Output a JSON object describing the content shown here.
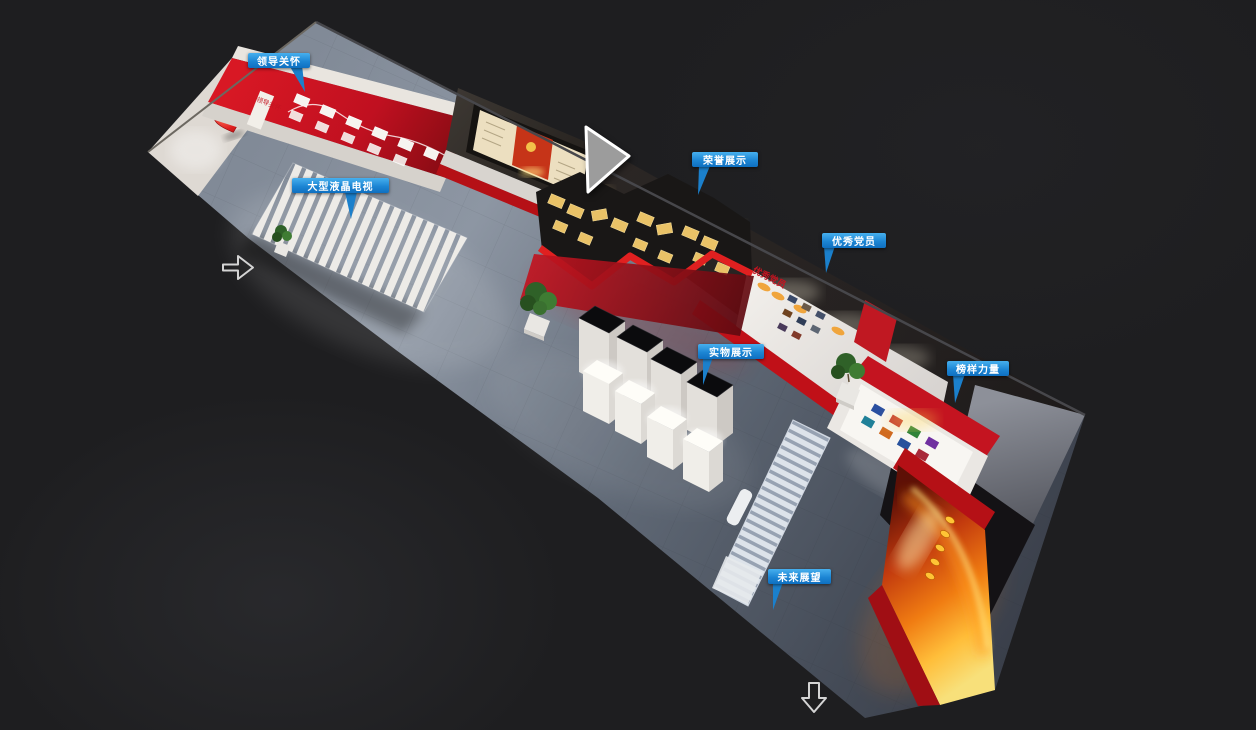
{
  "page": {
    "background": "#1e1e20"
  },
  "hotspots": [
    {
      "name": "leadership-care",
      "label": "领导关怀"
    },
    {
      "name": "large-lcd-tv",
      "label": "大型液晶电视"
    },
    {
      "name": "honor-display",
      "label": "荣誉展示"
    },
    {
      "name": "outstanding-party-members",
      "label": "优秀党员"
    },
    {
      "name": "physical-exhibits",
      "label": "实物展示"
    },
    {
      "name": "role-model-power",
      "label": "榜样力量"
    },
    {
      "name": "future-outlook",
      "label": "未来展望"
    }
  ],
  "wall_texts": {
    "leadership_wall_sign": "领导关怀",
    "party_members_wall_sign": "优秀党员"
  },
  "icons": {
    "nav_left": "arrow-right-outline-icon",
    "nav_down": "arrow-down-outline-icon",
    "pointer": "triangle-cursor-icon"
  },
  "colors": {
    "hotspot_top": "#47b0ee",
    "hotspot_bottom": "#0e6fc0",
    "accent_red": "#c41420",
    "plaque_gold": "#e9c267",
    "floor_gray": "#6b7480",
    "fire_orange": "#f07c12"
  }
}
